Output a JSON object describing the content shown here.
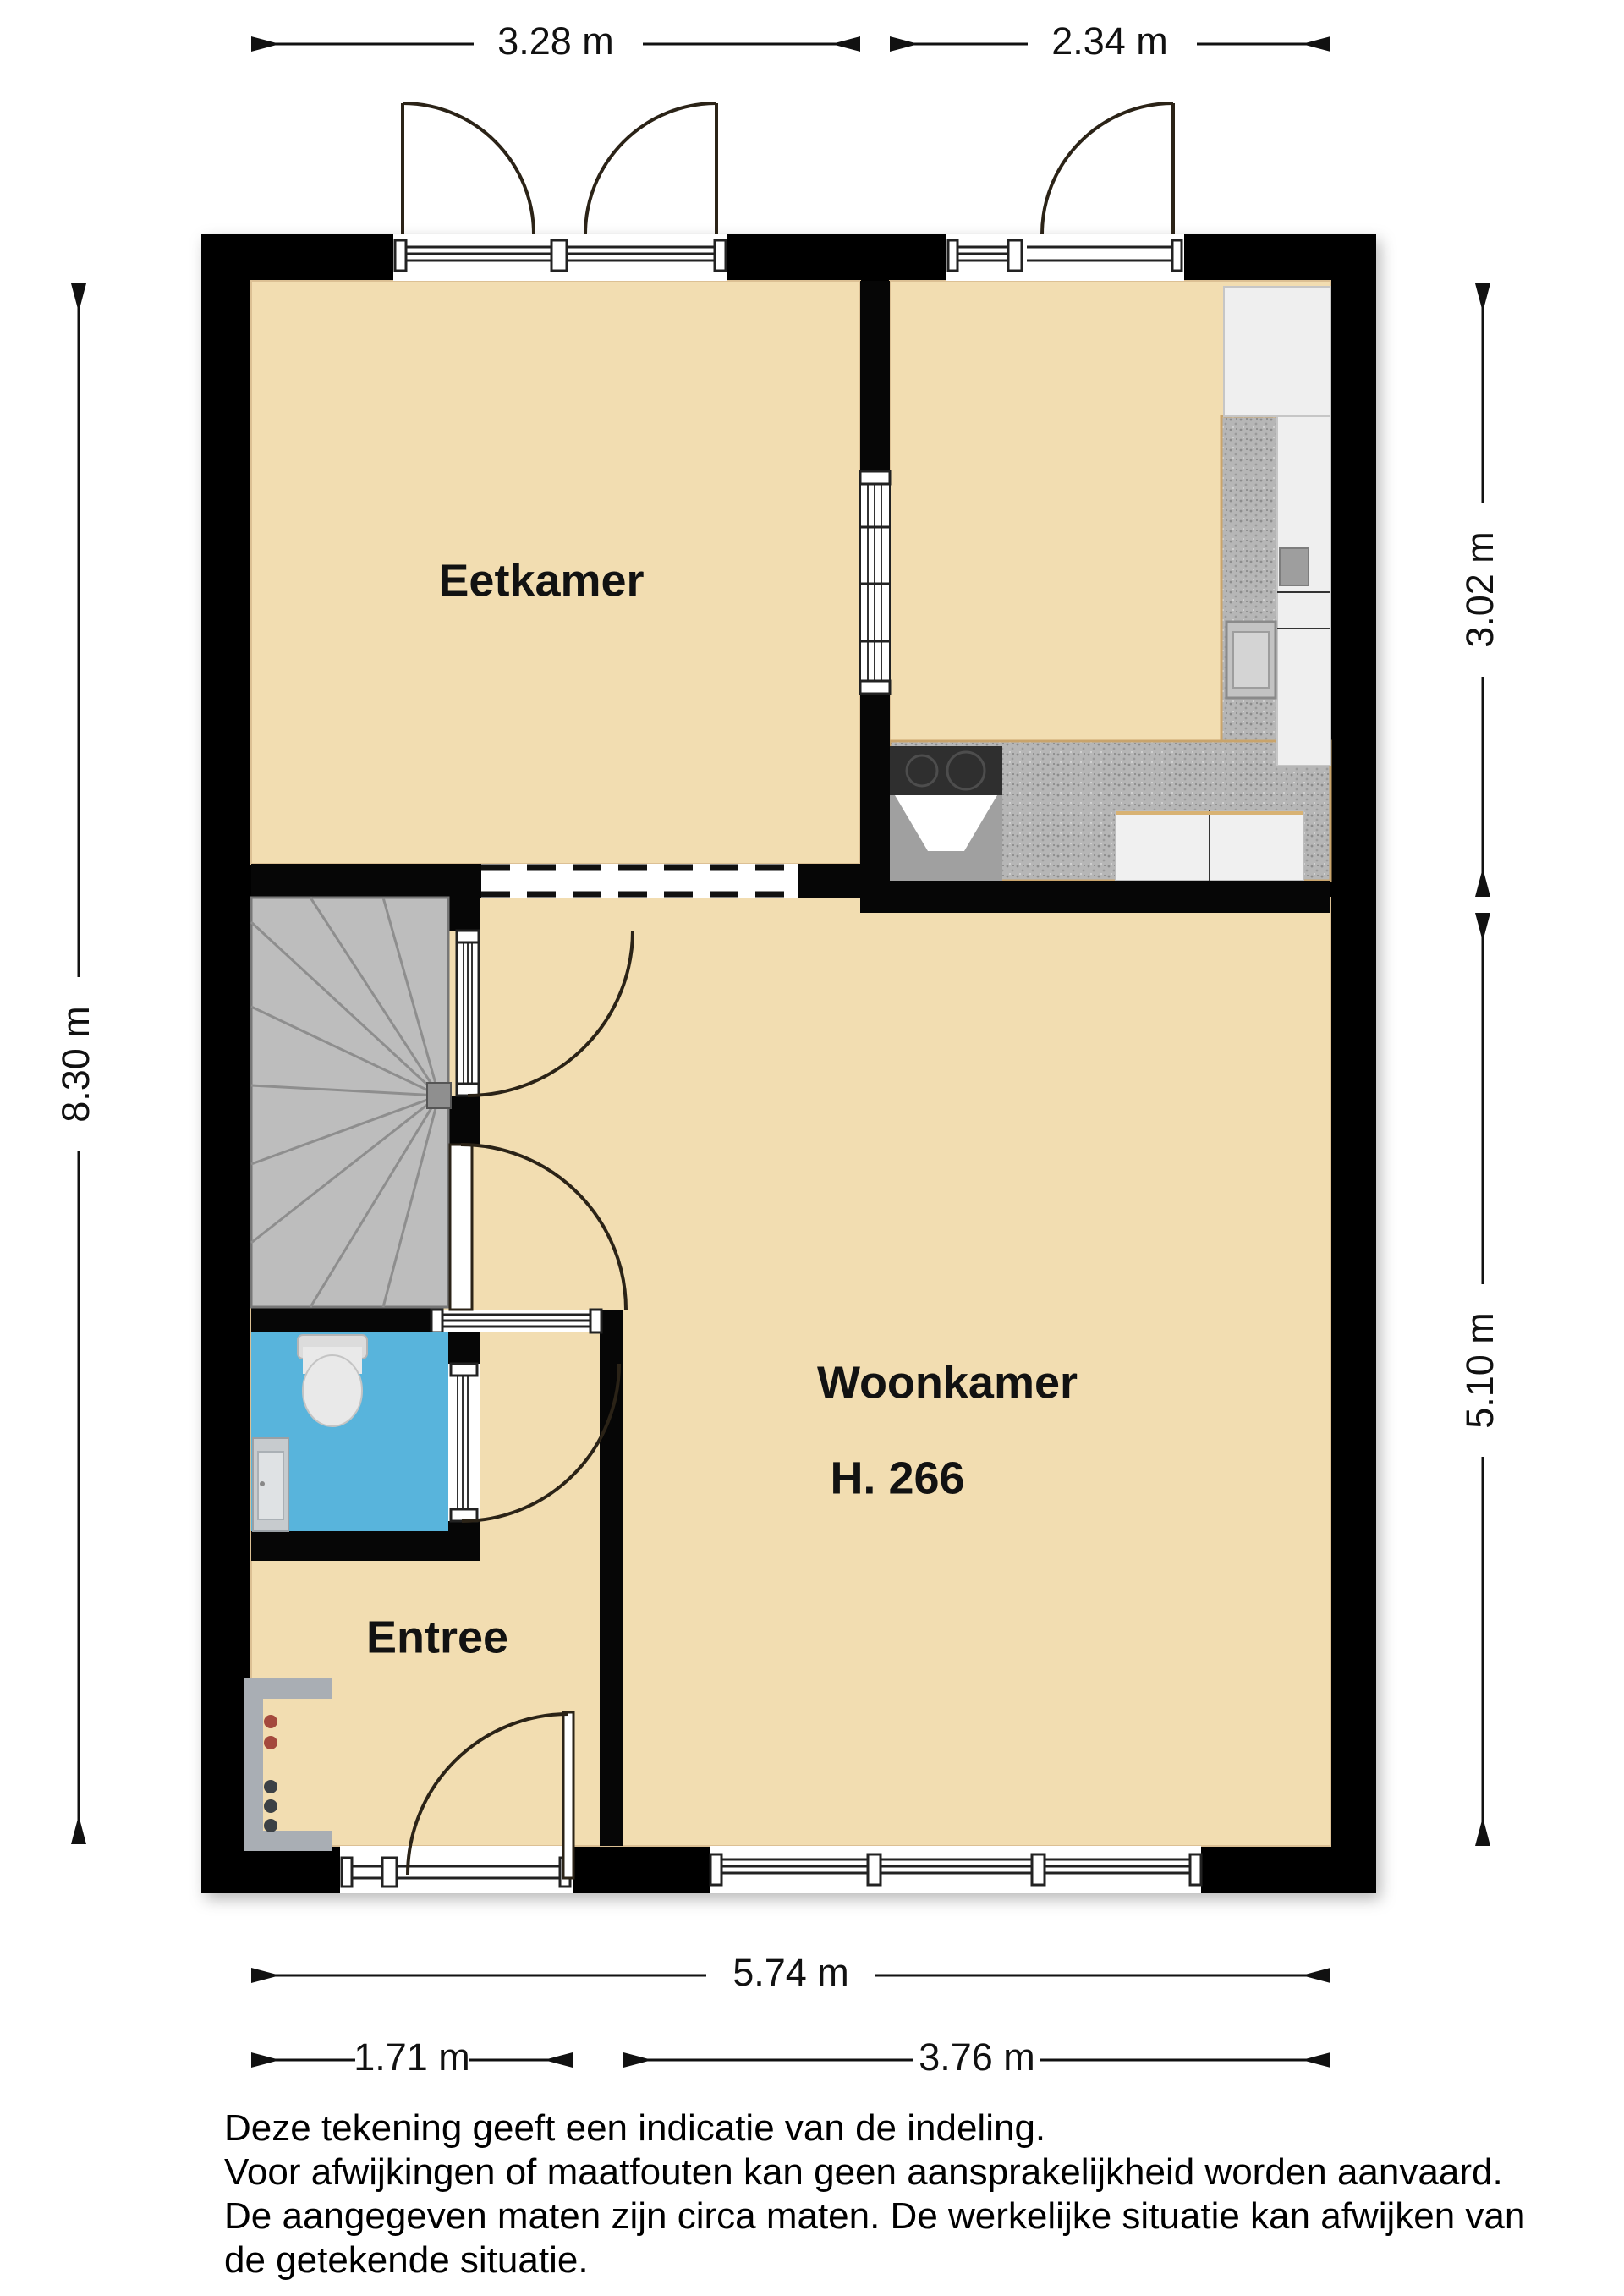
{
  "floorplan": {
    "rooms": {
      "eetkamer": {
        "label": "Eetkamer"
      },
      "woonkamer": {
        "label": "Woonkamer",
        "height": "H. 266"
      },
      "entree": {
        "label": "Entree"
      }
    },
    "dimensions": {
      "top_left": "3.28 m",
      "top_right": "2.34 m",
      "left": "8.30 m",
      "right_top": "3.02 m",
      "right_bottom": "5.10 m",
      "bottom": "5.74 m",
      "bottom_left": "1.71 m",
      "bottom_right": "3.76 m"
    },
    "disclaimer": {
      "line1": "Deze tekening geeft een indicatie van de indeling.",
      "line2": "Voor  afwijkingen of maatfouten kan geen aansprakelijkheid worden aanvaard.",
      "line3": "De aangegeven maten zijn circa maten. De werkelijke situatie kan afwijken van",
      "line4": "de getekende situatie."
    },
    "colors": {
      "wall": "#060606",
      "floor": "#f2ddb1",
      "toilet_floor": "#58b4dc",
      "stairs": "#bdbdbd",
      "counter": "#b6b6b6",
      "cabinet": "#f0f0f0"
    }
  }
}
